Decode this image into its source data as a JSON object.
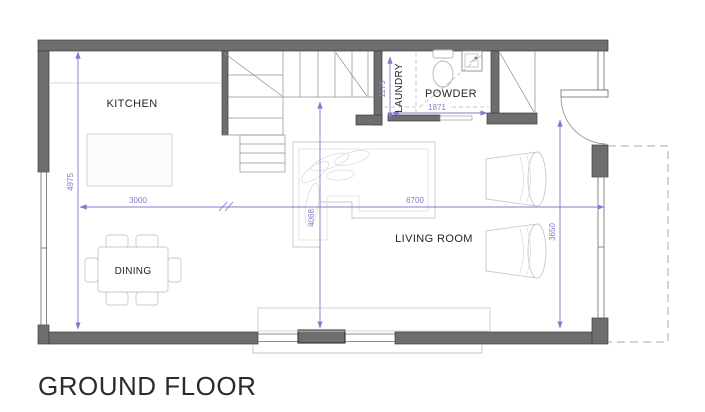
{
  "title": "GROUND FLOOR",
  "rooms": {
    "kitchen": {
      "label": "KITCHEN"
    },
    "dining": {
      "label": "DINING"
    },
    "living_room": {
      "label": "LIVING ROOM"
    },
    "laundry": {
      "label": "LAUNDRY"
    },
    "powder": {
      "label": "POWDER"
    }
  },
  "dimensions_mm": {
    "left_wall_height": "4975",
    "kitchen_width": "3000",
    "living_width": "6700",
    "interior_height": "4068",
    "living_height": "3650",
    "laundry_depth": "1175",
    "powder_width": "1871"
  },
  "colors": {
    "wall": "#6e6e6e",
    "dimension": "#8478d0",
    "label_text": "#262626",
    "furniture_outline": "#c9c9c9"
  }
}
